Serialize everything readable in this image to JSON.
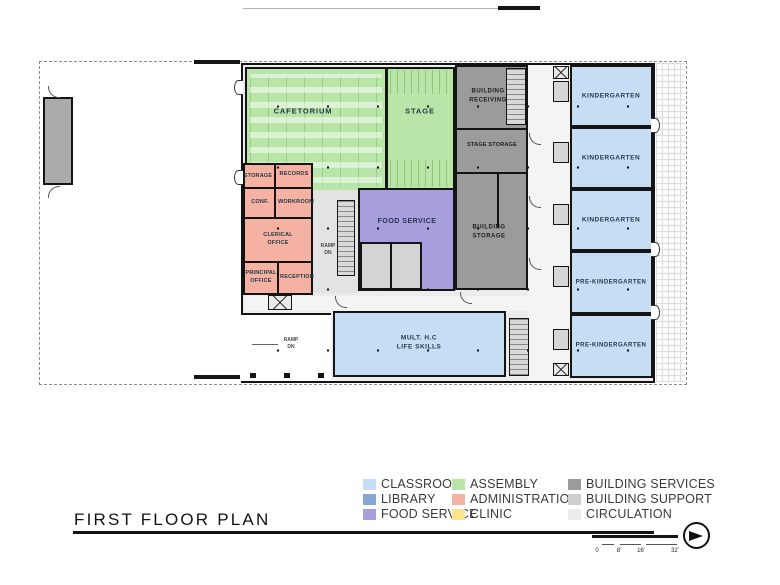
{
  "title": "FIRST FLOOR PLAN",
  "rooms": {
    "cafetorium": "CAFETORIUM",
    "stage": "STAGE",
    "building_receiving": "BUILDING\nRECEIVING",
    "stage_storage": "STAGE STORAGE",
    "building_storage": "BUILDING\nSTORAGE",
    "food_service": "FOOD SERVICE",
    "kindergarten": "KINDERGARTEN",
    "pre_kindergarten": "PRE-KINDERGARTEN",
    "mult_hc_life_skills": "MULT. H.C\nLIFE SKILLS",
    "storage": "STORAGE",
    "records": "RECORDS",
    "conf": "CONF.",
    "workroom": "WORKROOM",
    "clerical_office": "CLERICAL\nOFFICE",
    "principal_office": "PRINCIPAL\nOFFICE",
    "reception": "RECEPTION",
    "ramp_dn": "RAMP\nDN"
  },
  "colors": {
    "classroom": "#c7ddf3",
    "library": "#84a8d6",
    "food_service": "#a89ddd",
    "assembly": "#b9e5a9",
    "administration": "#f5b1a1",
    "clinic": "#fbe48a",
    "building_services": "#9b9b9b",
    "building_support": "#cecece",
    "circulation": "#ececec",
    "wall": "#141414"
  },
  "legend": {
    "items": [
      {
        "label": "CLASSROOM",
        "color": "#c7ddf3"
      },
      {
        "label": "LIBRARY",
        "color": "#84a8d6"
      },
      {
        "label": "FOOD SERVICE",
        "color": "#a89ddd"
      },
      {
        "label": "ASSEMBLY",
        "color": "#b9e5a9"
      },
      {
        "label": "ADMINISTRATION",
        "color": "#f5b1a1"
      },
      {
        "label": "CLINIC",
        "color": "#fbe48a"
      },
      {
        "label": "BUILDING SERVICES",
        "color": "#9b9b9b"
      },
      {
        "label": "BUILDING SUPPORT",
        "color": "#cecece"
      },
      {
        "label": "CIRCULATION",
        "color": "#ececec"
      }
    ]
  },
  "scale": {
    "ticks": [
      "0",
      "8'",
      "16'",
      "32'"
    ]
  }
}
